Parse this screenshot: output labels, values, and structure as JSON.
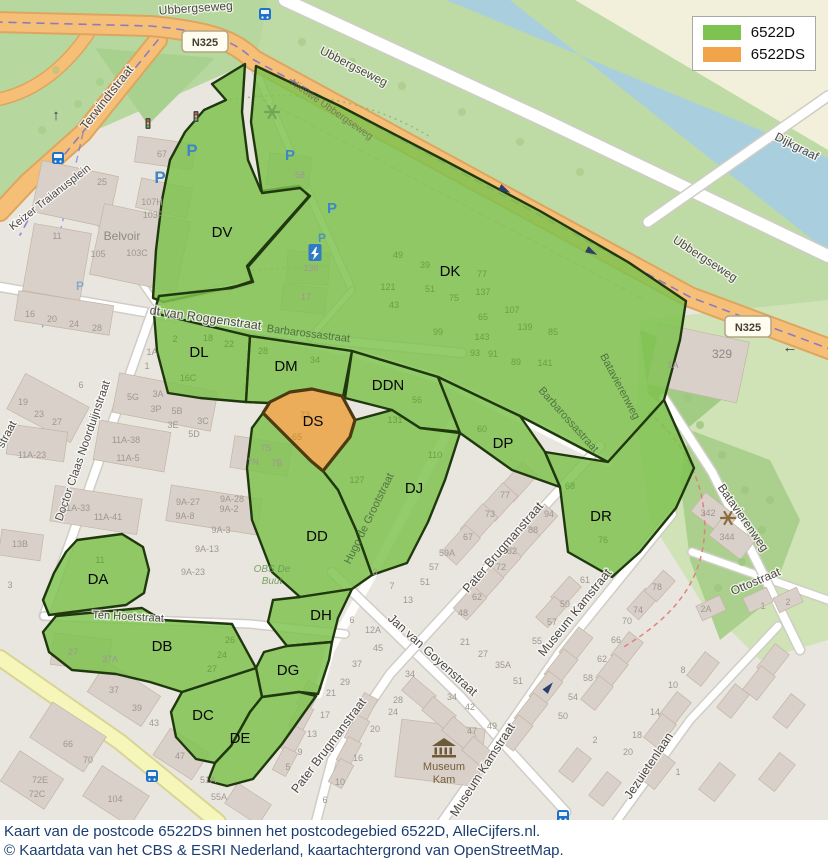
{
  "legend": {
    "items": [
      {
        "label": "6522D",
        "color": "#7ec24f"
      },
      {
        "label": "6522DS",
        "color": "#f2a44a"
      }
    ]
  },
  "caption": {
    "line1": "Kaart van de postcode 6522DS binnen het postcodegebied 6522D, AlleCijfers.nl.",
    "line2": "© Kaartdata van het CBS & ESRI Nederland, kaartachtergrond van OpenStreetMap."
  },
  "map": {
    "colors": {
      "region_fill": "#7ec24f",
      "region_stroke": "#20380e",
      "ds_fill": "#eaab54",
      "ds_stroke": "#4d3a10"
    },
    "road_badges": [
      {
        "t": "N325",
        "x": 205,
        "y": 42
      },
      {
        "t": "N325",
        "x": 748,
        "y": 327
      }
    ],
    "regions": [
      {
        "id": "DV",
        "label": "DV",
        "lx": 222,
        "ly": 237,
        "pts": "245,64 212,84 226,100 204,110 185,132 170,160 162,200 156,250 153,298 163,302 237,286 252,281 247,266 309,196 299,186 261,191 248,160 242,112"
      },
      {
        "id": "DK",
        "label": "DK",
        "lx": 450,
        "ly": 276,
        "pts": "256,66 340,106 440,158 540,211 628,262 686,301 680,340 664,400 608,462 520,416 438,377 352,351 250,336 154,313 159,296 232,288 253,282 248,267 310,196 300,188 262,193 251,122"
      },
      {
        "id": "DL",
        "label": "DL",
        "lx": 199,
        "ly": 357,
        "pts": "154,313 250,336 246,402 200,398 168,393 157,351"
      },
      {
        "id": "DM",
        "label": "DM",
        "lx": 286,
        "ly": 371,
        "pts": "250,336 352,351 343,397 312,389 290,392 268,403 246,402"
      },
      {
        "id": "DN",
        "label": "DDN",
        "lx": 388,
        "ly": 390,
        "pts": "352,351 438,377 460,432 420,428 392,410 345,398"
      },
      {
        "id": "DP",
        "label": "DP",
        "lx": 503,
        "ly": 448,
        "pts": "438,377 520,416 545,452 560,487 512,470 460,433"
      },
      {
        "id": "DR",
        "label": "DR",
        "lx": 601,
        "ly": 521,
        "pts": "545,452 608,462 664,400 694,468 676,508 640,552 612,577 568,552 560,487"
      },
      {
        "id": "DJ",
        "label": "DJ",
        "lx": 414,
        "ly": 493,
        "pts": "392,410 420,428 460,433 445,480 428,522 407,563 372,575 356,530 338,490 323,471 350,437 355,420"
      },
      {
        "id": "DD",
        "label": "DD",
        "lx": 317,
        "ly": 541,
        "pts": "263,413 311,461 323,471 338,490 356,530 372,575 352,589 300,597 272,572 252,520 247,468 252,428"
      },
      {
        "id": "DH",
        "label": "DH",
        "lx": 321,
        "ly": 620,
        "pts": "300,597 352,589 338,618 332,642 287,646 268,622 273,600"
      },
      {
        "id": "DG",
        "label": "DG",
        "lx": 288,
        "ly": 675,
        "pts": "287,646 332,642 329,660 318,694 299,692 262,697 256,668 264,652"
      },
      {
        "id": "DC",
        "label": "DC",
        "lx": 203,
        "ly": 720,
        "pts": "182,692 256,668 262,697 250,712 231,746 215,763 196,759 176,737 171,712"
      },
      {
        "id": "DE",
        "label": "DE",
        "lx": 240,
        "ly": 743,
        "pts": "250,712 262,697 299,692 316,696 282,744 253,779 227,786 208,781 215,763 231,746"
      },
      {
        "id": "DB",
        "label": "DB",
        "lx": 162,
        "ly": 651,
        "pts": "43,632 56,616 88,613 142,608 162,620 232,624 256,668 182,692 150,682 116,674 72,670 49,652"
      },
      {
        "id": "DA",
        "label": "DA",
        "lx": 98,
        "ly": 584,
        "pts": "77,540 122,534 143,547 149,570 144,593 126,605 49,615 43,600 54,573 66,552"
      },
      {
        "id": "DS",
        "label": "DS",
        "lx": 313,
        "ly": 426,
        "ds": true,
        "pts": "312,389 342,396 355,420 350,437 323,471 311,461 263,413 270,402 290,392"
      }
    ],
    "street_labels": [
      {
        "t": "Ubbergseweg",
        "x": 196,
        "y": 12,
        "r": -4,
        "s": 12
      },
      {
        "t": "Ubbergseweg",
        "x": 352,
        "y": 70,
        "r": 27,
        "s": 12
      },
      {
        "t": "Ubbergseweg",
        "x": 703,
        "y": 262,
        "r": 33,
        "s": 12
      },
      {
        "t": "Dijkgraaf",
        "x": 795,
        "y": 150,
        "r": 27,
        "s": 12
      },
      {
        "t": "Terwindtstraat",
        "x": 110,
        "y": 100,
        "r": -52,
        "s": 12.5
      },
      {
        "t": "Keizer Traianusplein",
        "x": 52,
        "y": 200,
        "r": -38,
        "s": 11
      },
      {
        "t": "dt van Roggenstraat",
        "x": 205,
        "y": 322,
        "r": 8,
        "s": 12.5
      },
      {
        "t": "Doctor Claas Noorduijnstraat",
        "x": 86,
        "y": 452,
        "r": -71,
        "s": 11.5
      },
      {
        "t": "straat",
        "x": 10,
        "y": 436,
        "r": -62,
        "s": 11.5
      },
      {
        "t": "Batavierenweg",
        "x": 740,
        "y": 520,
        "r": 55,
        "s": 12
      },
      {
        "t": "Ottostraat",
        "x": 757,
        "y": 585,
        "r": -23,
        "s": 12
      },
      {
        "t": "Ten Hoetstraat",
        "x": 128,
        "y": 620,
        "r": 3,
        "s": 11
      },
      {
        "t": "Jan van Goyenstraat",
        "x": 430,
        "y": 658,
        "r": 42,
        "s": 12.5
      },
      {
        "t": "Pater Brugmanstraat",
        "x": 506,
        "y": 550,
        "r": -49,
        "s": 12.5
      },
      {
        "t": "Pater Brugmanstraat",
        "x": 332,
        "y": 748,
        "r": -53,
        "s": 12.5
      },
      {
        "t": "Museum Kamstraat",
        "x": 578,
        "y": 615,
        "r": -51,
        "s": 12.5
      },
      {
        "t": "Museum Kamstraat",
        "x": 486,
        "y": 772,
        "r": -57,
        "s": 12.5
      },
      {
        "t": "Jezuietenlaan",
        "x": 652,
        "y": 768,
        "r": -56,
        "s": 12.5
      },
      {
        "t": "Barbarossastraat",
        "x": 308,
        "y": 337,
        "r": 7,
        "s": 11,
        "c": "g"
      },
      {
        "t": "Barbarossastraat",
        "x": 566,
        "y": 422,
        "r": 48,
        "s": 11,
        "c": "g"
      },
      {
        "t": "Batavierenweg",
        "x": 617,
        "y": 388,
        "r": 62,
        "s": 11,
        "c": "g"
      },
      {
        "t": "Hugo de Grootstraat",
        "x": 372,
        "y": 520,
        "r": -64,
        "s": 11,
        "c": "g"
      },
      {
        "t": "Nieuwe Ubbergseweg",
        "x": 330,
        "y": 112,
        "r": 35,
        "s": 10,
        "c": "f"
      }
    ],
    "house_numbers": [
      [
        "67",
        162,
        157
      ],
      [
        "58",
        300,
        178
      ],
      [
        "25",
        102,
        185
      ],
      [
        "11",
        57,
        239
      ],
      [
        "105",
        98,
        257
      ],
      [
        "103C",
        137,
        256
      ],
      [
        "107H",
        152,
        205
      ],
      [
        "103F",
        153,
        218
      ],
      [
        "136",
        311,
        271
      ],
      [
        "17",
        306,
        300
      ],
      [
        "16",
        30,
        317
      ],
      [
        "20",
        52,
        322
      ],
      [
        "24",
        74,
        327
      ],
      [
        "28",
        97,
        331
      ],
      [
        "6",
        81,
        388
      ],
      [
        "19",
        23,
        405
      ],
      [
        "23",
        39,
        417
      ],
      [
        "27",
        57,
        425
      ],
      [
        "5G",
        133,
        400
      ],
      [
        "3A",
        158,
        397
      ],
      [
        "3P",
        156,
        412
      ],
      [
        "5B",
        177,
        414
      ],
      [
        "3E",
        173,
        428
      ],
      [
        "3C",
        203,
        424
      ],
      [
        "5D",
        194,
        437
      ],
      [
        "7N",
        253,
        465
      ],
      [
        "7B",
        277,
        466
      ],
      [
        "7S",
        266,
        451
      ],
      [
        "11A-38",
        126,
        443
      ],
      [
        "11A-5",
        128,
        461
      ],
      [
        "11A-23",
        32,
        458
      ],
      [
        "11A-33",
        76,
        511
      ],
      [
        "11A-41",
        108,
        520
      ],
      [
        "9A-27",
        188,
        505
      ],
      [
        "9A-28",
        232,
        502
      ],
      [
        "9A-8",
        185,
        519
      ],
      [
        "9A-2",
        229,
        512
      ],
      [
        "9A-3",
        221,
        533
      ],
      [
        "9A-13",
        207,
        552
      ],
      [
        "9A-23",
        193,
        575
      ],
      [
        "13B",
        20,
        547
      ],
      [
        "3",
        10,
        588
      ],
      [
        "1A",
        152,
        355
      ],
      [
        "1",
        147,
        369
      ],
      [
        "27",
        73,
        655
      ],
      [
        "37A",
        110,
        662
      ],
      [
        "37",
        114,
        693
      ],
      [
        "39",
        137,
        711
      ],
      [
        "43",
        154,
        726
      ],
      [
        "66",
        68,
        747
      ],
      [
        "70",
        88,
        763
      ],
      [
        "72E",
        40,
        783
      ],
      [
        "72C",
        37,
        797
      ],
      [
        "104",
        115,
        802
      ],
      [
        "47",
        180,
        759
      ],
      [
        "51A",
        208,
        783
      ],
      [
        "55A",
        219,
        800
      ],
      [
        "77",
        505,
        498
      ],
      [
        "73",
        490,
        517
      ],
      [
        "67",
        468,
        540
      ],
      [
        "59A",
        447,
        556
      ],
      [
        "94",
        549,
        517
      ],
      [
        "88",
        533,
        533
      ],
      [
        "82",
        512,
        554
      ],
      [
        "72",
        501,
        570
      ],
      [
        "62",
        477,
        600
      ],
      [
        "48",
        463,
        616
      ],
      [
        "57",
        434,
        570
      ],
      [
        "51",
        425,
        585
      ],
      [
        "13",
        408,
        603
      ],
      [
        "7",
        392,
        589
      ],
      [
        "3",
        375,
        575
      ],
      [
        "61",
        585,
        583
      ],
      [
        "59",
        565,
        607
      ],
      [
        "342",
        708,
        516
      ],
      [
        "344",
        727,
        540
      ],
      [
        "2A",
        706,
        612
      ],
      [
        "1",
        763,
        609
      ],
      [
        "2",
        788,
        605
      ],
      [
        "78",
        657,
        590
      ],
      [
        "74",
        638,
        613
      ],
      [
        "29",
        345,
        685
      ],
      [
        "21",
        331,
        696
      ],
      [
        "17",
        325,
        718
      ],
      [
        "13",
        312,
        737
      ],
      [
        "9",
        300,
        755
      ],
      [
        "5",
        288,
        770
      ],
      [
        "28",
        398,
        703
      ],
      [
        "24",
        393,
        715
      ],
      [
        "20",
        375,
        732
      ],
      [
        "16",
        358,
        761
      ],
      [
        "10",
        340,
        785
      ],
      [
        "6",
        325,
        803
      ],
      [
        "6",
        352,
        623
      ],
      [
        "12A",
        373,
        633
      ],
      [
        "45",
        378,
        651
      ],
      [
        "37",
        357,
        667
      ],
      [
        "34",
        410,
        677
      ],
      [
        "21",
        465,
        645
      ],
      [
        "27",
        483,
        657
      ],
      [
        "35A",
        503,
        668
      ],
      [
        "51",
        518,
        684
      ],
      [
        "57",
        552,
        625
      ],
      [
        "55",
        537,
        644
      ],
      [
        "34",
        452,
        700
      ],
      [
        "42",
        470,
        710
      ],
      [
        "47",
        472,
        734
      ],
      [
        "49",
        492,
        729
      ],
      [
        "58",
        588,
        681
      ],
      [
        "54",
        573,
        700
      ],
      [
        "50",
        563,
        719
      ],
      [
        "62",
        602,
        662
      ],
      [
        "66",
        616,
        643
      ],
      [
        "70",
        627,
        624
      ],
      [
        "2",
        595,
        743
      ],
      [
        "18",
        637,
        738
      ],
      [
        "20",
        628,
        755
      ],
      [
        "8",
        683,
        673
      ],
      [
        "10",
        673,
        688
      ],
      [
        "14",
        655,
        715
      ],
      [
        "1",
        678,
        775
      ],
      [
        "1A",
        673,
        368
      ]
    ],
    "big_numbers": [
      [
        "329",
        722,
        358
      ]
    ],
    "green_numbers": [
      [
        "49",
        398,
        258
      ],
      [
        "39",
        425,
        268
      ],
      [
        "77",
        482,
        277
      ],
      [
        "121",
        388,
        290
      ],
      [
        "51",
        430,
        292
      ],
      [
        "137",
        483,
        295
      ],
      [
        "75",
        454,
        301
      ],
      [
        "43",
        394,
        308
      ],
      [
        "107",
        512,
        313
      ],
      [
        "65",
        483,
        320
      ],
      [
        "139",
        525,
        330
      ],
      [
        "85",
        553,
        335
      ],
      [
        "99",
        438,
        335
      ],
      [
        "143",
        482,
        340
      ],
      [
        "93",
        475,
        356
      ],
      [
        "91",
        493,
        357
      ],
      [
        "89",
        516,
        365
      ],
      [
        "141",
        545,
        366
      ],
      [
        "2",
        175,
        342
      ],
      [
        "18",
        208,
        341
      ],
      [
        "22",
        229,
        347
      ],
      [
        "16C",
        188,
        381
      ],
      [
        "28",
        263,
        354
      ],
      [
        "34",
        315,
        363
      ],
      [
        "56",
        417,
        403
      ],
      [
        "131",
        395,
        423
      ],
      [
        "110",
        435,
        458
      ],
      [
        "127",
        357,
        483
      ],
      [
        "60",
        482,
        432
      ],
      [
        "68",
        570,
        489
      ],
      [
        "76",
        603,
        543
      ],
      [
        "11",
        100,
        563
      ],
      [
        "26",
        230,
        643
      ],
      [
        "24",
        222,
        658
      ],
      [
        "27",
        212,
        672
      ]
    ],
    "ds_numbers": [
      [
        "73",
        305,
        418
      ],
      [
        "65",
        297,
        440
      ]
    ],
    "pois": {
      "museum": {
        "label": "Museum Kam",
        "x": 444,
        "y": 766
      },
      "school": {
        "label": "OBS De Buut",
        "x": 272,
        "y": 572
      },
      "belvoir": {
        "label": "Belvoir",
        "x": 122,
        "y": 240
      }
    },
    "icons": {
      "parking": [
        [
          160,
          183,
          17,
          1
        ],
        [
          192,
          156,
          17,
          1
        ],
        [
          290,
          160,
          15,
          1
        ],
        [
          332,
          213,
          15,
          1
        ],
        [
          322,
          242,
          12,
          0.8
        ],
        [
          80,
          290,
          12,
          0.5
        ]
      ],
      "bus": [
        [
          265,
          14
        ],
        [
          58,
          158
        ],
        [
          152,
          776
        ],
        [
          563,
          816
        ]
      ],
      "traffic_light": [
        [
          148,
          124
        ],
        [
          196,
          117
        ]
      ],
      "charging_station": [
        [
          315,
          252
        ]
      ],
      "park_symbol": [
        [
          272,
          112,
          "#74a557"
        ],
        [
          728,
          518,
          "#8a6d3b"
        ]
      ],
      "arrow_glyphs": [
        {
          "t": "←",
          "x": 790,
          "y": 352
        },
        {
          "t": "↑",
          "x": 56,
          "y": 120
        }
      ],
      "arrow_triangles": [
        {
          "x": 505,
          "y": 190,
          "r": 28
        },
        {
          "x": 592,
          "y": 252,
          "r": 28
        },
        {
          "x": 549,
          "y": 687,
          "r": -50
        }
      ]
    }
  }
}
